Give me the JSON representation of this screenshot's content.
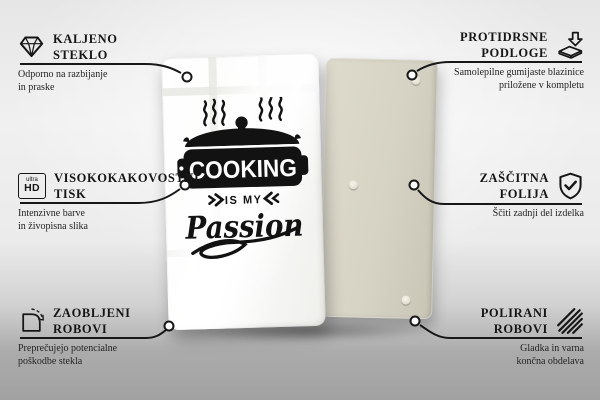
{
  "product": {
    "front_board": {
      "kind": "glass front with print",
      "color": "#ffffff",
      "design": {
        "line1": "COOKING",
        "line2": "IS MY",
        "line3": "Passion"
      }
    },
    "back_board": {
      "kind": "back side with anti-slip pads",
      "color": "#d6d3c4",
      "visible_pads": 3
    }
  },
  "features": [
    {
      "id": "tempered-glass",
      "icon": "diamond-icon",
      "title_line1": "KALJENO",
      "title_line2": "STEKLO",
      "description_line1": "Odporno na razbijanje",
      "description_line2": "in praske"
    },
    {
      "id": "anti-slip-pads",
      "icon": "pad-arrow-icon",
      "title_line1": "PROTIDRSNE",
      "title_line2": "PODLOGE",
      "description_line1": "Samolepilne gumijaste blazinice",
      "description_line2": "priložene v kompletu"
    },
    {
      "id": "high-quality-print",
      "icon": "ultra-hd-icon",
      "icon_label_top": "ultra",
      "icon_label_bottom": "HD",
      "title_line1": "VISOKOKAKOVOSTNI",
      "title_line2": "TISK",
      "description_line1": "Intenzivne barve",
      "description_line2": "in živopisna slika"
    },
    {
      "id": "protective-film",
      "icon": "shield-check-icon",
      "title_line1": "ZAŠČITNA",
      "title_line2": "FOLIJA",
      "description_line1": "Ščiti zadnji del izdelka",
      "description_line2": ""
    },
    {
      "id": "rounded-edges",
      "icon": "rounded-corner-icon",
      "title_line1": "ZAOBLJENI",
      "title_line2": "ROBOVI",
      "description_line1": "Preprečujejo potencialne",
      "description_line2": "poškodbe stekla"
    },
    {
      "id": "polished-edges",
      "icon": "diagonal-lines-icon",
      "title_line1": "POLIRANI",
      "title_line2": "ROBOVI",
      "description_line1": "Gladka in varna",
      "description_line2": "končna obdelava"
    }
  ],
  "colors": {
    "line_accent": "#171717",
    "text": "#161616",
    "glass_front": "#ffffff",
    "back_panel": "#d6d3c4",
    "background_top": "#f0f0f0",
    "background_floor": "#a2a2a2"
  }
}
